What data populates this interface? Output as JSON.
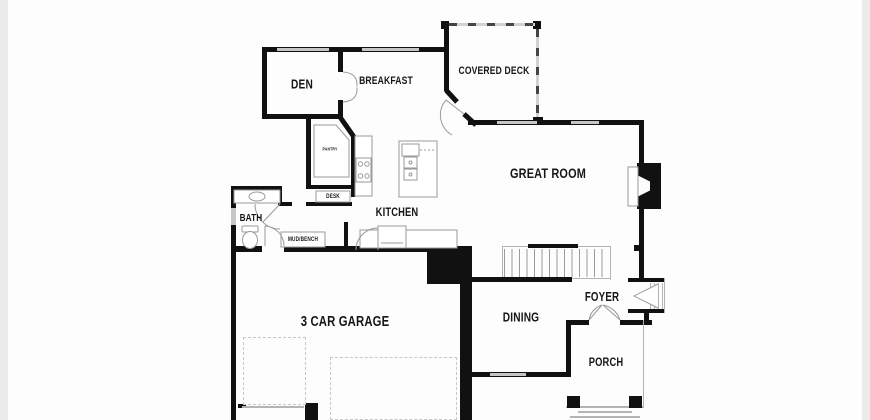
{
  "floorplan": {
    "rooms": {
      "den": {
        "label": "DEN"
      },
      "breakfast": {
        "label": "BREAKFAST"
      },
      "covered_deck": {
        "label": "COVERED DECK"
      },
      "great_room": {
        "label": "GREAT ROOM"
      },
      "pantry": {
        "label": "PANTRY"
      },
      "desk": {
        "label": "DESK"
      },
      "kitchen": {
        "label": "KITCHEN"
      },
      "bath": {
        "label": "BATH"
      },
      "mud_bench": {
        "label": "MUD/BENCH"
      },
      "garage": {
        "label": "3 CAR GARAGE"
      },
      "dining": {
        "label": "DINING"
      },
      "foyer": {
        "label": "FOYER"
      },
      "porch": {
        "label": "PORCH"
      }
    },
    "colors": {
      "wall": "#111111",
      "window": "#c6c6c6",
      "thin_line": "#9a9a9a",
      "dashed": "#c8c8c8",
      "background": "#ffffff"
    }
  }
}
